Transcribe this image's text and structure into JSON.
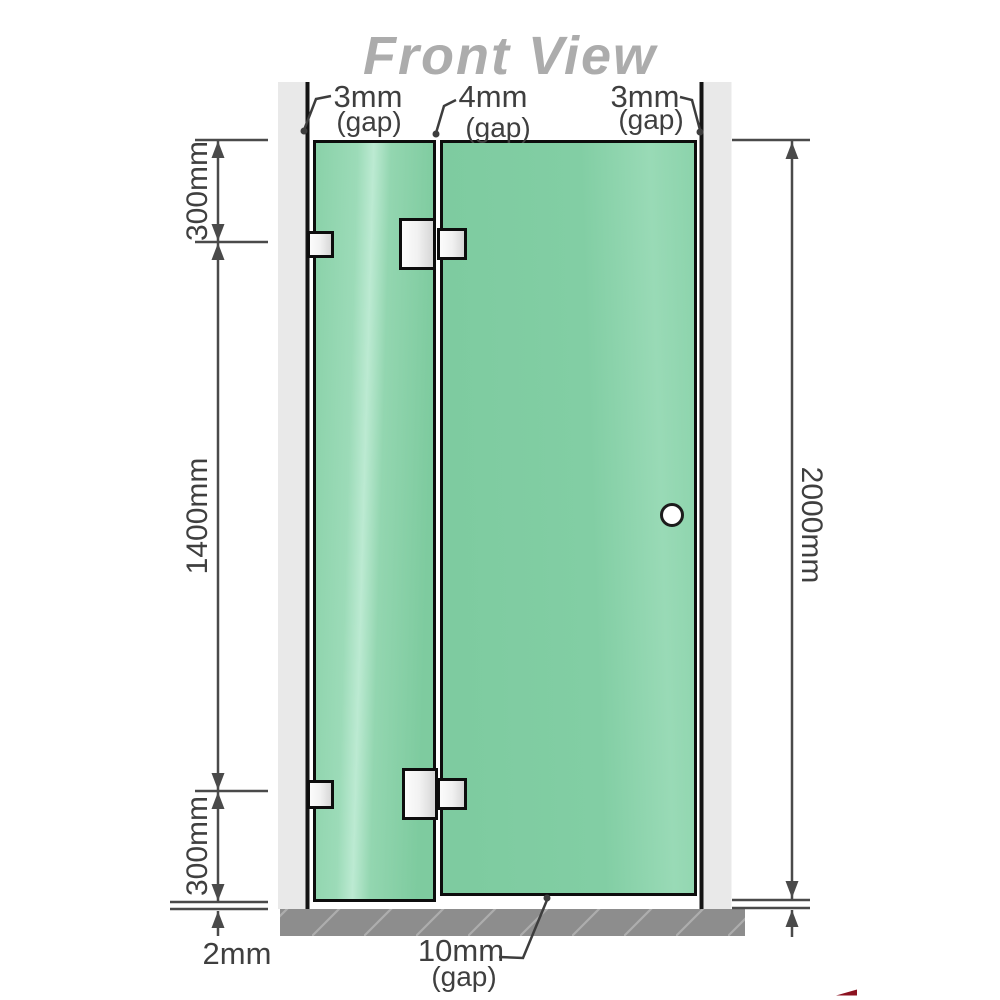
{
  "diagram": {
    "title": "Front View",
    "top_gaps": [
      {
        "value": "3mm",
        "suffix": "(gap)"
      },
      {
        "value": "4mm",
        "suffix": "(gap)"
      },
      {
        "value": "3mm",
        "suffix": "(gap)"
      }
    ],
    "left_dims": {
      "top_segment": "300mm",
      "middle_segment": "1400mm",
      "bottom_segment": "300mm"
    },
    "right_dim": {
      "total_height": "2000mm"
    },
    "bottom_dims": {
      "floor_gap": "2mm",
      "door_gap_value": "10mm",
      "door_gap_suffix": "(gap)"
    },
    "colors": {
      "glass": "#7ecba1",
      "glass_highlight": "#bcead2",
      "wall_channel": "#e9e9e9",
      "floor": "#8d8d8d",
      "outline": "#0d0d0d",
      "dimension": "#4a4a4a",
      "title": "#acacac",
      "logo_red": "#8c1220"
    }
  }
}
